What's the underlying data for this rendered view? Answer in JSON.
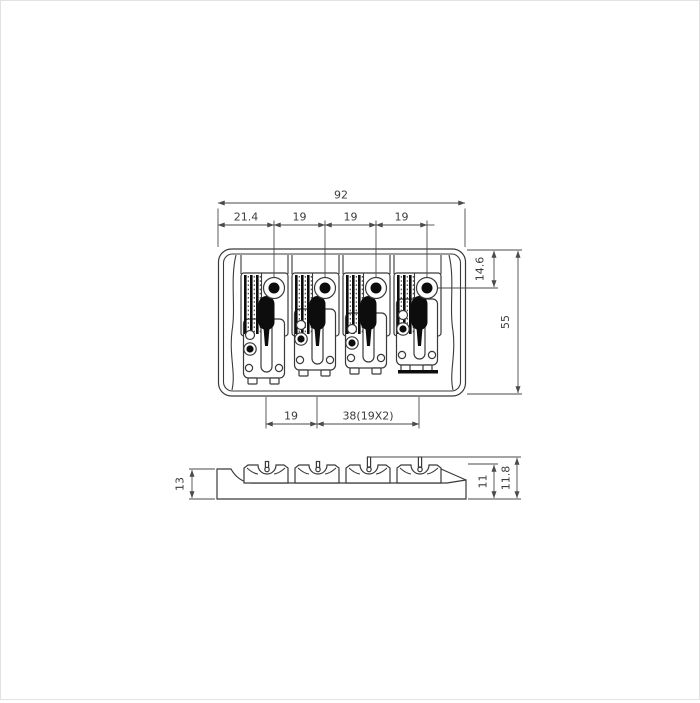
{
  "drawing": {
    "subject": "4-string bass bridge dimension drawing",
    "units": "mm",
    "line_color": "#3a3a3a",
    "background": "#ffffff"
  },
  "dims": {
    "top_view": {
      "overall_width": "92",
      "spacings": [
        "21.4",
        "19",
        "19",
        "19"
      ],
      "edge_to_screw": "14.6",
      "depth": "55",
      "saddle_pitch": "19",
      "outer_string_span": "38(19X2)"
    },
    "side_view": {
      "plate_height": "13",
      "saddle_height": "11",
      "overall_height": "11.8"
    }
  }
}
